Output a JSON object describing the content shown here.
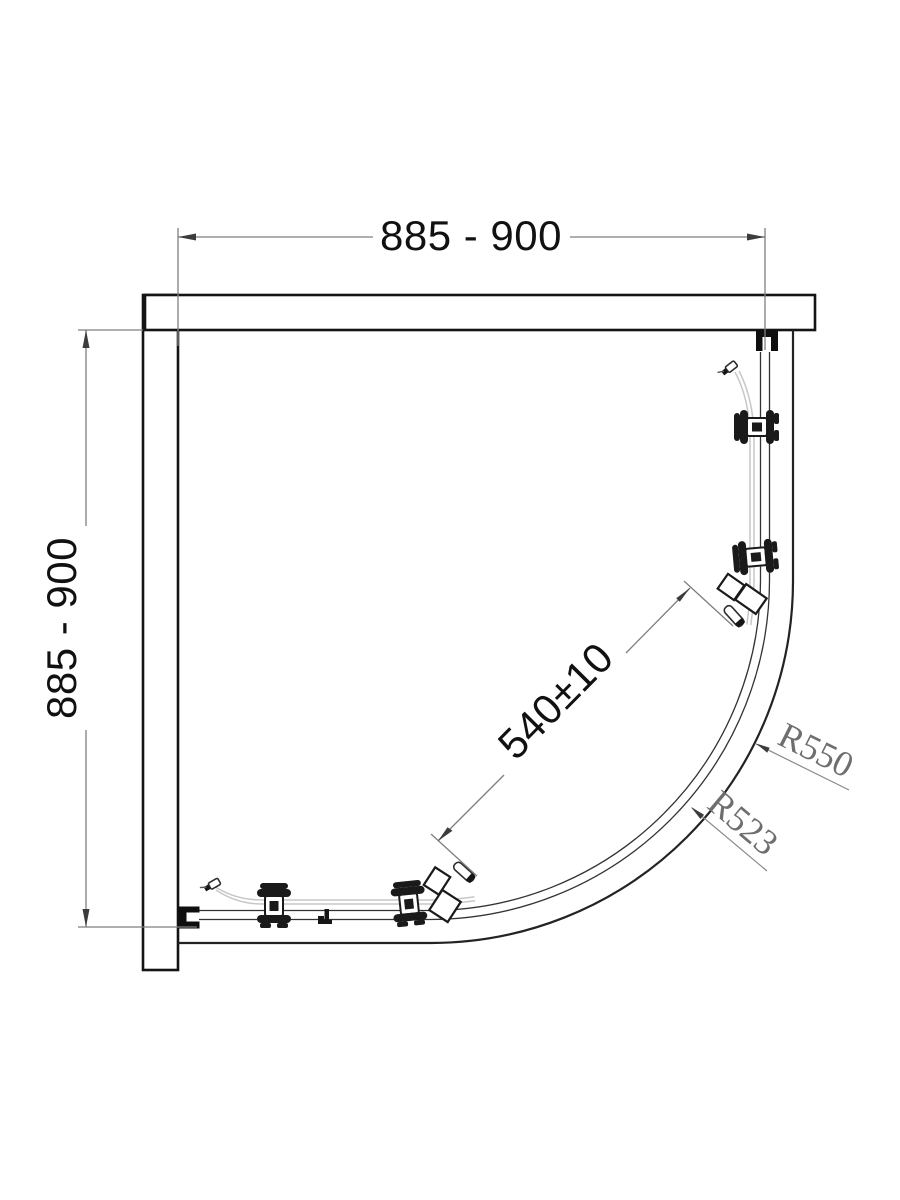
{
  "diagram": {
    "dimensions": {
      "width_label": "885 - 900",
      "depth_label": "885 - 900",
      "opening_label": "540±10",
      "radius_outer_label": "R550",
      "radius_inner_label": "R523"
    },
    "colors": {
      "background": "#ffffff",
      "wall_line": "#141414",
      "tray_line": "#232323",
      "rail_line": "#333333",
      "glass_line": "#c7c7c7",
      "dimension_line": "#7f7f7f",
      "dimension_text": "#111111",
      "radius_text": "#6e6e6e"
    }
  }
}
